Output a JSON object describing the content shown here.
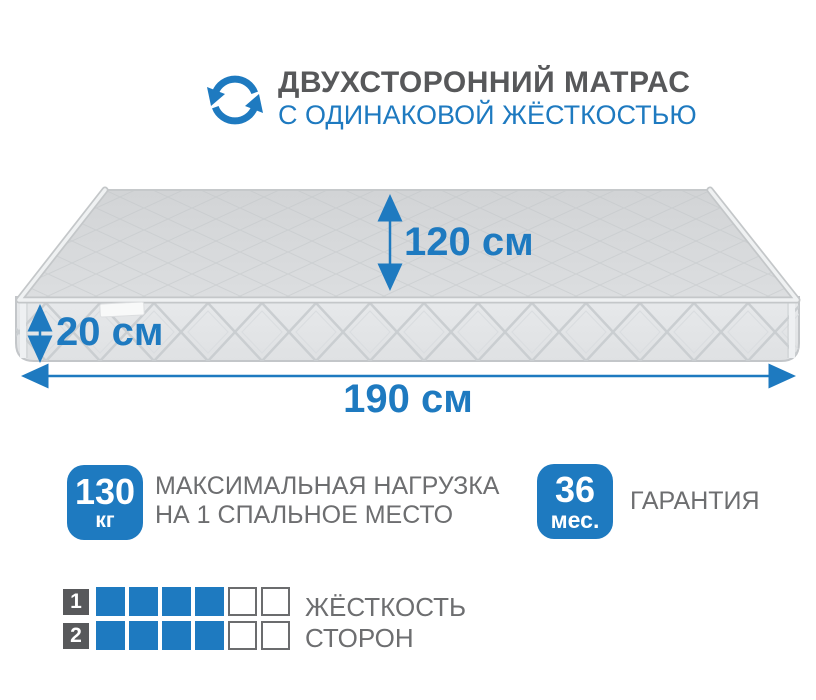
{
  "header": {
    "icon": "rotate-arrows-icon",
    "title_line1": "ДВУХСТОРОННИЙ МАТРАС",
    "title_line2": "С ОДИНАКОВОЙ ЖЁСТКОСТЬЮ"
  },
  "dimensions": {
    "depth_label": "120 см",
    "height_label": "20 см",
    "length_label": "190 см"
  },
  "features": {
    "max_load": {
      "value": "130",
      "unit": "кг",
      "label_line1": "МАКСИМАЛЬНАЯ НАГРУЗКА",
      "label_line2": "НА 1 СПАЛЬНОЕ МЕСТО"
    },
    "warranty": {
      "value": "36",
      "unit": "мес.",
      "label": "ГАРАНТИЯ"
    }
  },
  "firmness": {
    "label_line1": "ЖЁСТКОСТЬ",
    "label_line2": "СТОРОН",
    "scale_max": 6,
    "rows": [
      {
        "side": "1",
        "value": 4
      },
      {
        "side": "2",
        "value": 4
      }
    ]
  },
  "colors": {
    "accent_blue": "#1e7ac0",
    "title_gray": "#57585a",
    "text_gray": "#6d6e70",
    "square_dark": "#58595b",
    "mattress_top": "#d8dadc",
    "mattress_front": "#e4e6e8"
  }
}
